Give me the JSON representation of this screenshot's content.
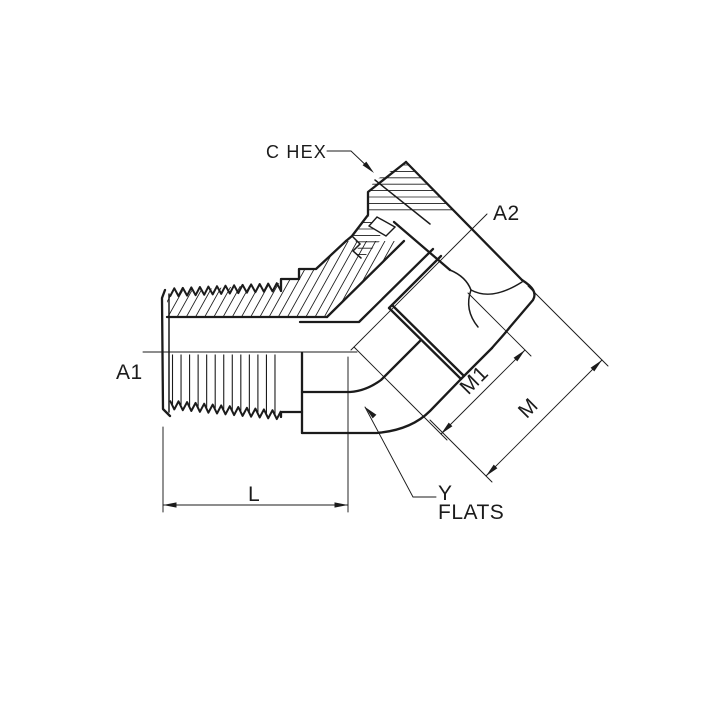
{
  "colors": {
    "background": "#ffffff",
    "line": "#1b1b1b"
  },
  "diagram": {
    "labels": {
      "c_hex": "C HEX",
      "a2": "A2",
      "a1": "A1",
      "m1": "M1",
      "m": "M",
      "l": "L",
      "y": "Y",
      "flats": "FLATS"
    }
  }
}
